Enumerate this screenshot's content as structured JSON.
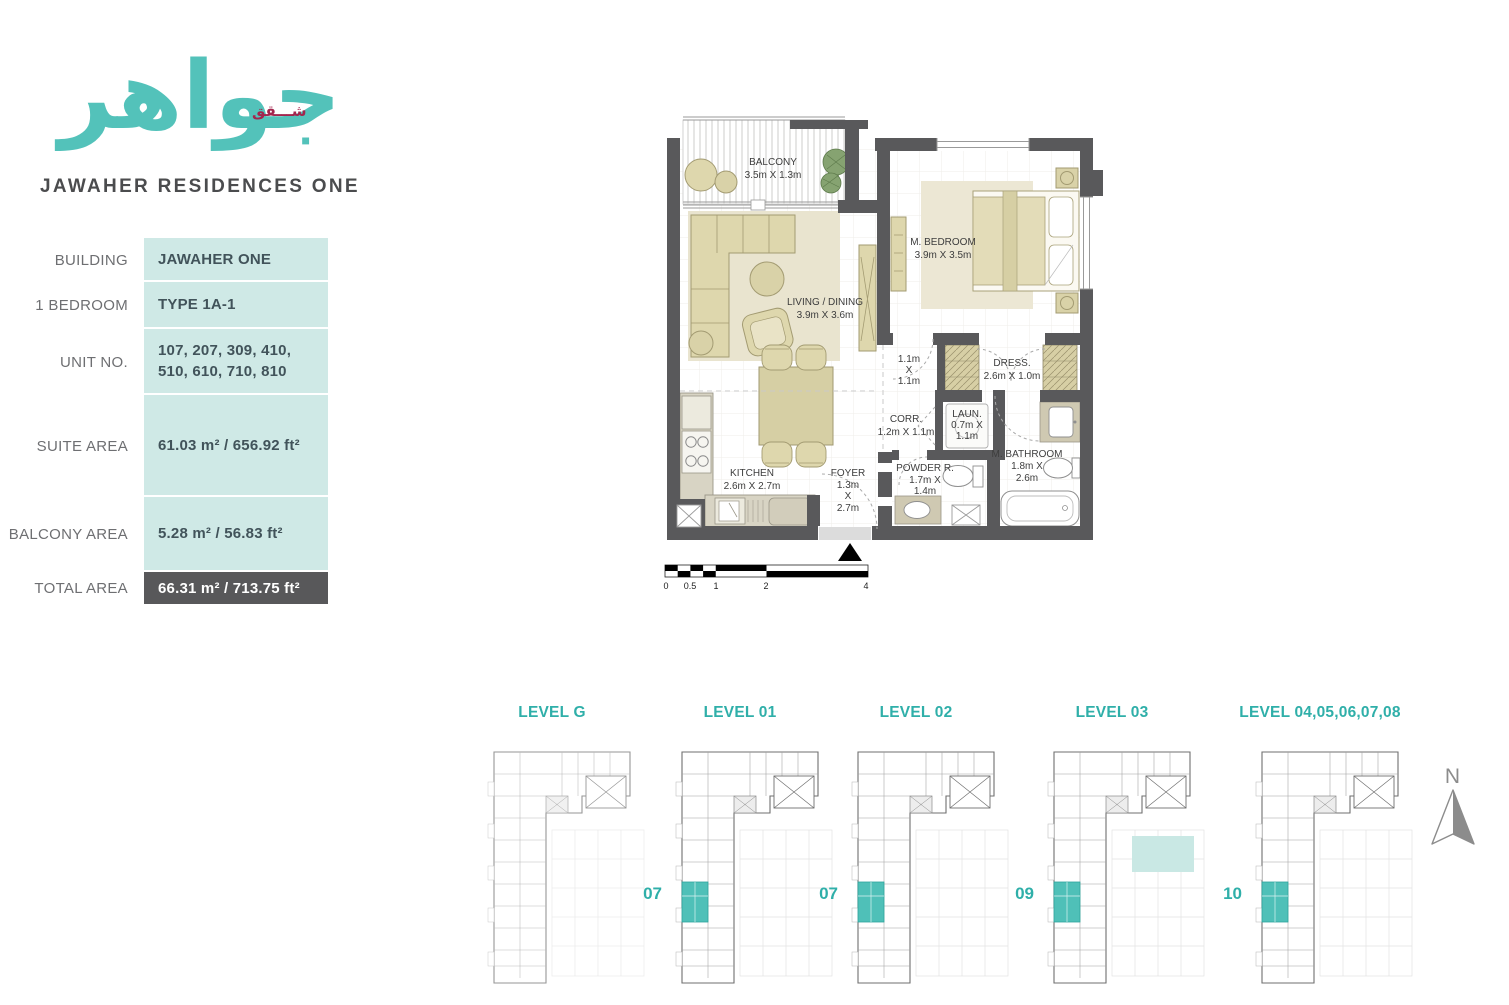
{
  "brand": {
    "logo_arabic": "جواهر",
    "logo_arabic_small": "شـــقق",
    "name": "JAWAHER RESIDENCES ONE"
  },
  "unit_info": {
    "rows": [
      {
        "label": "BUILDING",
        "value": "JAWAHER ONE"
      },
      {
        "label": "1 BEDROOM",
        "value": "TYPE 1A-1"
      },
      {
        "label": "UNIT NO.",
        "value": "107, 207, 309, 410, 510, 610, 710, 810"
      },
      {
        "label": "SUITE AREA",
        "value": "61.03 m² / 656.92 ft²"
      },
      {
        "label": "BALCONY AREA",
        "value": "5.28 m² / 56.83 ft²"
      },
      {
        "label": "TOTAL AREA",
        "value": "66.31 m² / 713.75 ft²"
      }
    ]
  },
  "floor_plan": {
    "rooms": [
      {
        "name": "BALCONY",
        "dims": [
          "3.5m  X 1.3m"
        ]
      },
      {
        "name": "M. BEDROOM",
        "dims": [
          "3.9m X 3.5m"
        ]
      },
      {
        "name": "LIVING / DINING",
        "dims": [
          "3.9m X 3.6m"
        ]
      },
      {
        "name": "KITCHEN",
        "dims": [
          "2.6m X 2.7m"
        ]
      },
      {
        "name": "FOYER",
        "dims": [
          "1.3m",
          "X",
          "2.7m"
        ]
      },
      {
        "name": "CORR.",
        "dims": [
          "1.2m X 1.1m"
        ]
      },
      {
        "name": "LAUN.",
        "dims": [
          "0.7m X",
          "1.1m"
        ]
      },
      {
        "name": "POWDER R.",
        "dims": [
          "1.7m X",
          "1.4m"
        ]
      },
      {
        "name": "M. BATHROOM",
        "dims": [
          "1.8m X",
          "2.6m"
        ]
      },
      {
        "name": "DRESS.",
        "dims": [
          "2.6m  X 1.0m"
        ]
      },
      {
        "name": "1.1m",
        "dims": [
          "X",
          "1.1m"
        ]
      }
    ],
    "scale_ticks": [
      "0",
      "0.5",
      "1",
      "2",
      "4"
    ]
  },
  "levels": [
    {
      "title": "LEVEL G",
      "unit": ""
    },
    {
      "title": "LEVEL 01",
      "unit": "07"
    },
    {
      "title": "LEVEL 02",
      "unit": "07"
    },
    {
      "title": "LEVEL 03",
      "unit": "09"
    },
    {
      "title": "LEVEL 04,05,06,07,08",
      "unit": "10"
    }
  ],
  "compass": {
    "label": "N"
  },
  "colors": {
    "brand_teal": "#53c2ba",
    "level_teal": "#2fafa9",
    "accent_maroon": "#a3254d",
    "table_mint": "#cfe9e6",
    "dark_gray": "#58585a",
    "wall_gray": "#59595b",
    "furniture_beige": "#ded7ad"
  }
}
